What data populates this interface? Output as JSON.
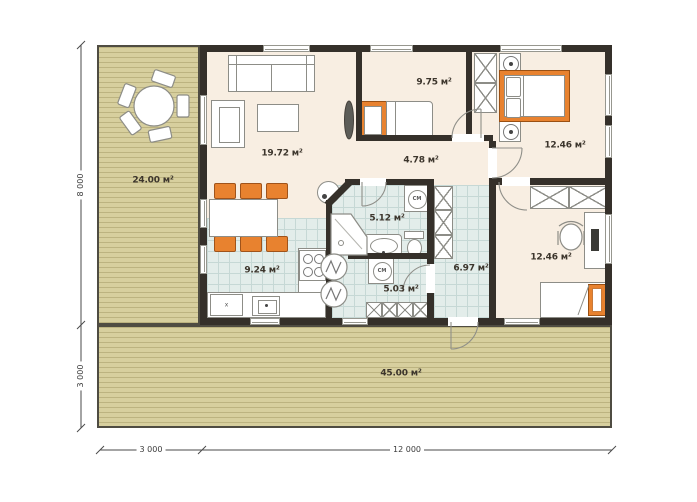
{
  "plan": {
    "rooms": {
      "living_room": {
        "area_label": "19.72 м²"
      },
      "bedroom_small": {
        "area_label": "9.75 м²"
      },
      "hallway": {
        "area_label": "4.78 м²"
      },
      "bedroom_master": {
        "area_label": "12.46 м²"
      },
      "kitchen": {
        "area_label": "9.24 м²"
      },
      "bathroom": {
        "area_label": "5.12 м²"
      },
      "utility": {
        "area_label": "5.03 м²"
      },
      "corridor": {
        "area_label": "6.97 м²"
      },
      "bedroom_office": {
        "area_label": "12.46 м²"
      },
      "terrace_side": {
        "area_label": "24.00 м²"
      },
      "terrace_front": {
        "area_label": "45.00 м²"
      }
    },
    "dimensions": {
      "height_house": "8 000",
      "height_terrace": "3 000",
      "width_terrace": "3 000",
      "width_house": "12 000"
    },
    "appliances": {
      "washing_machine_label": "СМ",
      "kitchen_unit_label": "x"
    },
    "colors": {
      "wall": "#35302a",
      "floor": "#f8eee2",
      "tile": "#e3edea",
      "deck": "#d7cf9e",
      "accent_orange": "#e8822f"
    }
  }
}
